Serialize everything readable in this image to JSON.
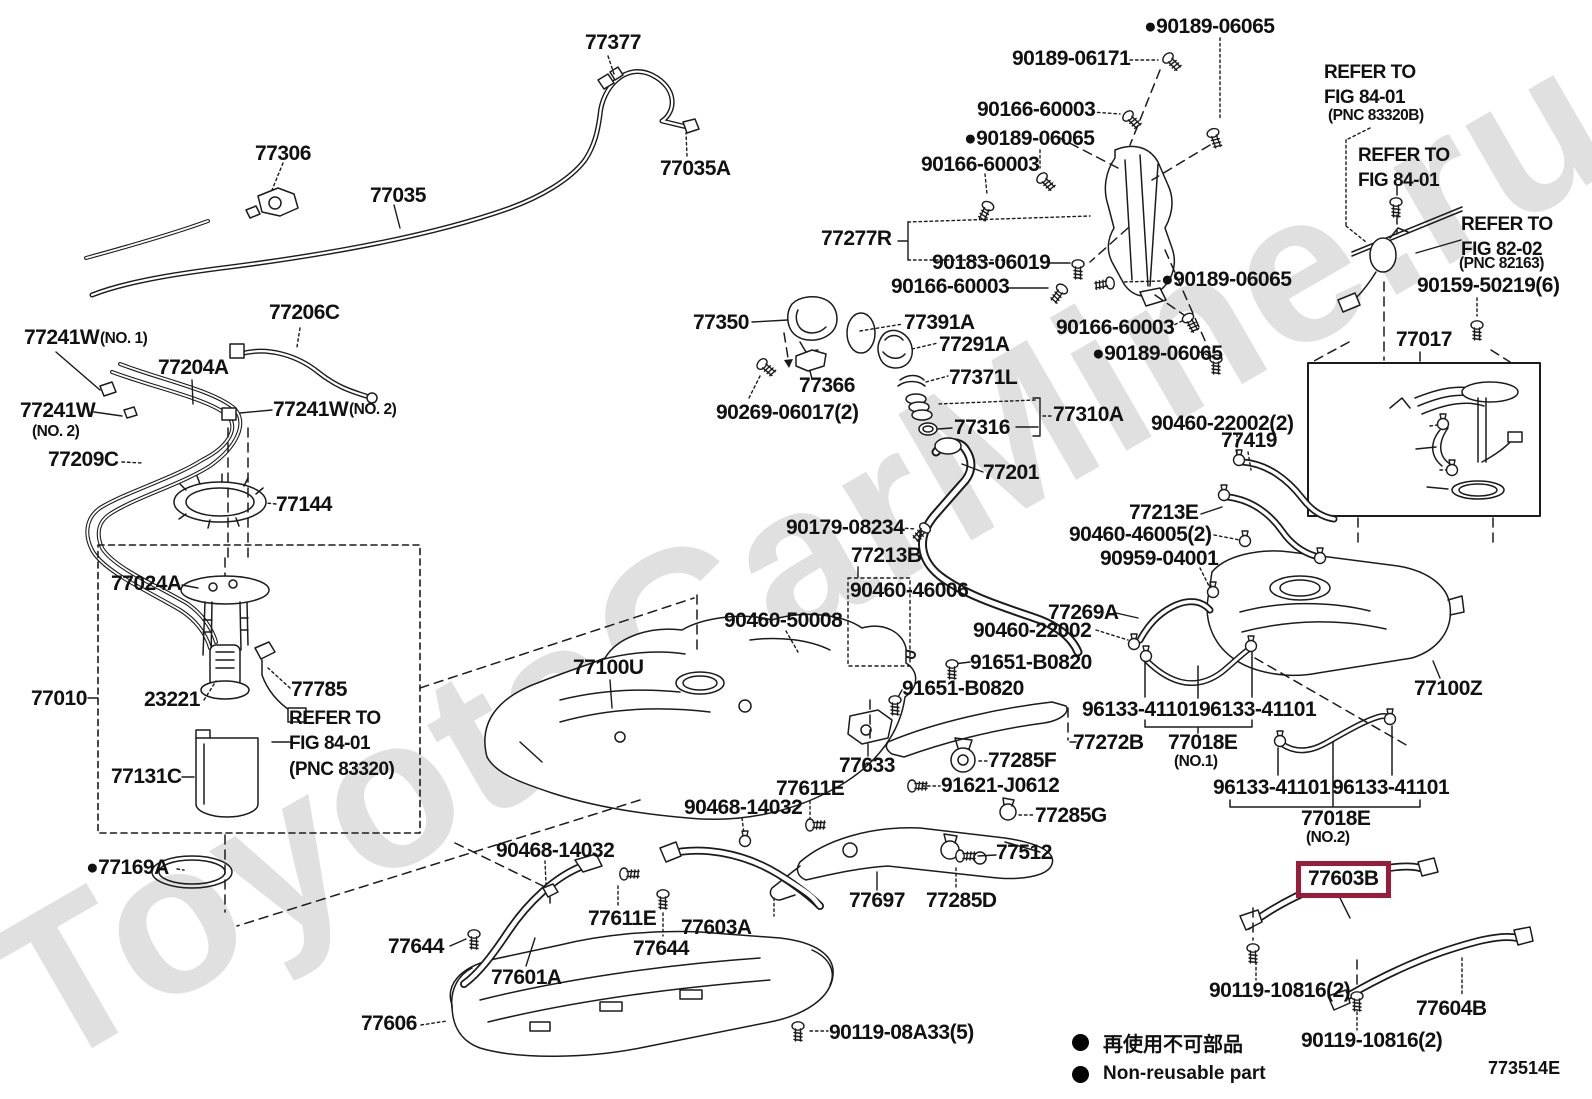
{
  "doc": {
    "code": "773514E",
    "watermark": "ToyotaCarMine.ru"
  },
  "colors": {
    "highlight": "#9c1b38",
    "line": "#1b1b1b"
  },
  "legend": {
    "jp": "再使用不可部品",
    "en": "Non-reusable part"
  },
  "highlight": {
    "text": "77603B",
    "x": 1296,
    "y": 861
  },
  "labels": [
    {
      "t": "77377",
      "x": 585,
      "y": 32,
      "s": "lg",
      "i": true
    },
    {
      "t": "77306",
      "x": 255,
      "y": 143,
      "s": "lg",
      "i": true
    },
    {
      "t": "77035",
      "x": 370,
      "y": 185,
      "s": "lg",
      "i": true
    },
    {
      "t": "77035A",
      "x": 660,
      "y": 158,
      "s": "lg",
      "i": true
    },
    {
      "t": "●90189-06065",
      "x": 1144,
      "y": 16,
      "s": "lg",
      "i": true
    },
    {
      "t": "90189-06171",
      "x": 1012,
      "y": 48,
      "s": "lg",
      "i": true
    },
    {
      "t": "90166-60003",
      "x": 977,
      "y": 99,
      "s": "lg",
      "i": true
    },
    {
      "t": "●90189-06065",
      "x": 964,
      "y": 128,
      "s": "lg",
      "i": true
    },
    {
      "t": "90166-60003",
      "x": 921,
      "y": 154,
      "s": "lg",
      "i": true
    },
    {
      "t": "77277R",
      "x": 821,
      "y": 228,
      "s": "lg",
      "i": true
    },
    {
      "t": "90183-06019",
      "x": 932,
      "y": 252,
      "s": "lg",
      "i": true
    },
    {
      "t": "90166-60003",
      "x": 891,
      "y": 276,
      "s": "lg",
      "i": true
    },
    {
      "t": "●90189-06065",
      "x": 1161,
      "y": 269,
      "s": "lg",
      "i": true
    },
    {
      "t": "90166-60003",
      "x": 1056,
      "y": 317,
      "s": "lg",
      "i": true
    },
    {
      "t": "●90189-06065",
      "x": 1092,
      "y": 343,
      "s": "lg",
      "i": true
    },
    {
      "t": "REFER TO\nFIG 84-01",
      "x": 1324,
      "y": 60,
      "s": "rf",
      "i": false
    },
    {
      "t": "(PNC 83320B)",
      "x": 1328,
      "y": 108,
      "s": "md",
      "i": false
    },
    {
      "t": "REFER TO\nFIG 84-01",
      "x": 1358,
      "y": 143,
      "s": "rf",
      "i": false
    },
    {
      "t": "REFER TO\nFIG 82-02",
      "x": 1461,
      "y": 212,
      "s": "rf",
      "i": false
    },
    {
      "t": "(PNC 82163)",
      "x": 1459,
      "y": 256,
      "s": "md",
      "i": false
    },
    {
      "t": "90159-50219(6)",
      "x": 1417,
      "y": 275,
      "s": "lg",
      "i": true
    },
    {
      "t": "77017",
      "x": 1396,
      "y": 329,
      "s": "lg",
      "i": true
    },
    {
      "t": "77241W",
      "x": 24,
      "y": 327,
      "s": "lg",
      "i": true
    },
    {
      "t": "(NO. 1)",
      "x": 100,
      "y": 331,
      "s": "md",
      "i": false
    },
    {
      "t": "77206C",
      "x": 269,
      "y": 302,
      "s": "lg",
      "i": true
    },
    {
      "t": "77204A",
      "x": 158,
      "y": 357,
      "s": "lg",
      "i": true
    },
    {
      "t": "77241W",
      "x": 20,
      "y": 400,
      "s": "lg",
      "i": true
    },
    {
      "t": "(NO. 2)",
      "x": 32,
      "y": 424,
      "s": "md",
      "i": false
    },
    {
      "t": "77241W",
      "x": 273,
      "y": 399,
      "s": "lg",
      "i": true
    },
    {
      "t": "(NO. 2)",
      "x": 349,
      "y": 402,
      "s": "md",
      "i": false
    },
    {
      "t": "77209C",
      "x": 48,
      "y": 449,
      "s": "lg",
      "i": true
    },
    {
      "t": "77144",
      "x": 276,
      "y": 494,
      "s": "lg",
      "i": true
    },
    {
      "t": "77350",
      "x": 693,
      "y": 312,
      "s": "lg",
      "i": true
    },
    {
      "t": "77391A",
      "x": 904,
      "y": 312,
      "s": "lg",
      "i": true
    },
    {
      "t": "77291A",
      "x": 939,
      "y": 334,
      "s": "lg",
      "i": true
    },
    {
      "t": "77366",
      "x": 799,
      "y": 375,
      "s": "lg",
      "i": true
    },
    {
      "t": "77371L",
      "x": 949,
      "y": 367,
      "s": "lg",
      "i": true
    },
    {
      "t": "90269-06017(2)",
      "x": 716,
      "y": 402,
      "s": "lg",
      "i": true
    },
    {
      "t": "77316",
      "x": 954,
      "y": 417,
      "s": "lg",
      "i": true
    },
    {
      "t": "77310A",
      "x": 1053,
      "y": 404,
      "s": "lg",
      "i": true
    },
    {
      "t": "77201",
      "x": 983,
      "y": 462,
      "s": "lg",
      "i": true
    },
    {
      "t": "90179-08234",
      "x": 786,
      "y": 517,
      "s": "lg",
      "i": true
    },
    {
      "t": "77213B",
      "x": 851,
      "y": 545,
      "s": "lg",
      "i": true
    },
    {
      "t": "90460-46006",
      "x": 850,
      "y": 580,
      "s": "lg",
      "i": true
    },
    {
      "t": "90460-50008",
      "x": 724,
      "y": 610,
      "s": "lg",
      "i": true
    },
    {
      "t": "77100U",
      "x": 573,
      "y": 657,
      "s": "lg",
      "i": true
    },
    {
      "t": "90460-22002(2)",
      "x": 1151,
      "y": 413,
      "s": "lg",
      "i": true
    },
    {
      "t": "77419",
      "x": 1221,
      "y": 430,
      "s": "lg",
      "i": true
    },
    {
      "t": "77213E",
      "x": 1129,
      "y": 502,
      "s": "lg",
      "i": true
    },
    {
      "t": "90460-46005(2)",
      "x": 1069,
      "y": 524,
      "s": "lg",
      "i": true
    },
    {
      "t": "90959-04001",
      "x": 1100,
      "y": 548,
      "s": "lg",
      "i": true
    },
    {
      "t": "77269A",
      "x": 1048,
      "y": 602,
      "s": "lg",
      "i": true
    },
    {
      "t": "90460-22002",
      "x": 973,
      "y": 620,
      "s": "lg",
      "i": true
    },
    {
      "t": "91651-B0820",
      "x": 970,
      "y": 652,
      "s": "lg",
      "i": true
    },
    {
      "t": "91651-B0820",
      "x": 902,
      "y": 678,
      "s": "lg",
      "i": true
    },
    {
      "t": "96133-41101",
      "x": 1082,
      "y": 699,
      "s": "lg",
      "i": true
    },
    {
      "t": "96133-41101",
      "x": 1199,
      "y": 699,
      "s": "lg",
      "i": true
    },
    {
      "t": "77018E",
      "x": 1168,
      "y": 732,
      "s": "lg",
      "i": true
    },
    {
      "t": "(NO.1)",
      "x": 1174,
      "y": 754,
      "s": "md",
      "i": false
    },
    {
      "t": "77100Z",
      "x": 1414,
      "y": 678,
      "s": "lg",
      "i": true
    },
    {
      "t": "77272B",
      "x": 1073,
      "y": 732,
      "s": "lg",
      "i": true
    },
    {
      "t": "96133-41101",
      "x": 1213,
      "y": 777,
      "s": "lg",
      "i": true
    },
    {
      "t": "96133-41101",
      "x": 1332,
      "y": 777,
      "s": "lg",
      "i": true
    },
    {
      "t": "77018E",
      "x": 1301,
      "y": 808,
      "s": "lg",
      "i": true
    },
    {
      "t": "(NO.2)",
      "x": 1306,
      "y": 830,
      "s": "md",
      "i": false
    },
    {
      "t": "77285G",
      "x": 1035,
      "y": 805,
      "s": "lg",
      "i": true
    },
    {
      "t": "77633",
      "x": 839,
      "y": 755,
      "s": "lg",
      "i": true
    },
    {
      "t": "77611E",
      "x": 776,
      "y": 778,
      "s": "lg",
      "i": true
    },
    {
      "t": "90468-14032",
      "x": 684,
      "y": 797,
      "s": "lg",
      "i": true
    },
    {
      "t": "77285F",
      "x": 988,
      "y": 750,
      "s": "lg",
      "i": true
    },
    {
      "t": "91621-J0612",
      "x": 941,
      "y": 775,
      "s": "lg",
      "i": true
    },
    {
      "t": "77512",
      "x": 996,
      "y": 842,
      "s": "lg",
      "i": true
    },
    {
      "t": "77697",
      "x": 849,
      "y": 890,
      "s": "lg",
      "i": true
    },
    {
      "t": "77285D",
      "x": 926,
      "y": 890,
      "s": "lg",
      "i": true
    },
    {
      "t": "90119-08A33(5)",
      "x": 829,
      "y": 1022,
      "s": "lg",
      "i": true
    },
    {
      "t": "●77169A",
      "x": 86,
      "y": 857,
      "s": "lg",
      "i": true
    },
    {
      "t": "90468-14032",
      "x": 496,
      "y": 840,
      "s": "lg",
      "i": true
    },
    {
      "t": "77644",
      "x": 388,
      "y": 936,
      "s": "lg",
      "i": true
    },
    {
      "t": "77601A",
      "x": 491,
      "y": 967,
      "s": "lg",
      "i": true
    },
    {
      "t": "77606",
      "x": 361,
      "y": 1013,
      "s": "lg",
      "i": true
    },
    {
      "t": "77611E",
      "x": 588,
      "y": 908,
      "s": "lg",
      "i": true
    },
    {
      "t": "77603A",
      "x": 681,
      "y": 917,
      "s": "lg",
      "i": true
    },
    {
      "t": "77644",
      "x": 633,
      "y": 938,
      "s": "lg",
      "i": true
    },
    {
      "t": "90119-10816(2)",
      "x": 1209,
      "y": 980,
      "s": "lg",
      "i": true
    },
    {
      "t": "77604B",
      "x": 1416,
      "y": 998,
      "s": "lg",
      "i": true
    },
    {
      "t": "90119-10816(2)",
      "x": 1301,
      "y": 1030,
      "s": "lg",
      "i": true
    },
    {
      "t": "77024A",
      "x": 111,
      "y": 573,
      "s": "lg",
      "i": true
    },
    {
      "t": "77010",
      "x": 31,
      "y": 688,
      "s": "lg",
      "i": true
    },
    {
      "t": "23221",
      "x": 144,
      "y": 689,
      "s": "lg",
      "i": true
    },
    {
      "t": "77785",
      "x": 291,
      "y": 679,
      "s": "lg",
      "i": true
    },
    {
      "t": "REFER TO\nFIG 84-01\n(PNC 83320)",
      "x": 289,
      "y": 706,
      "s": "rf",
      "i": false
    },
    {
      "t": "77131C",
      "x": 111,
      "y": 766,
      "s": "lg",
      "i": true
    }
  ]
}
